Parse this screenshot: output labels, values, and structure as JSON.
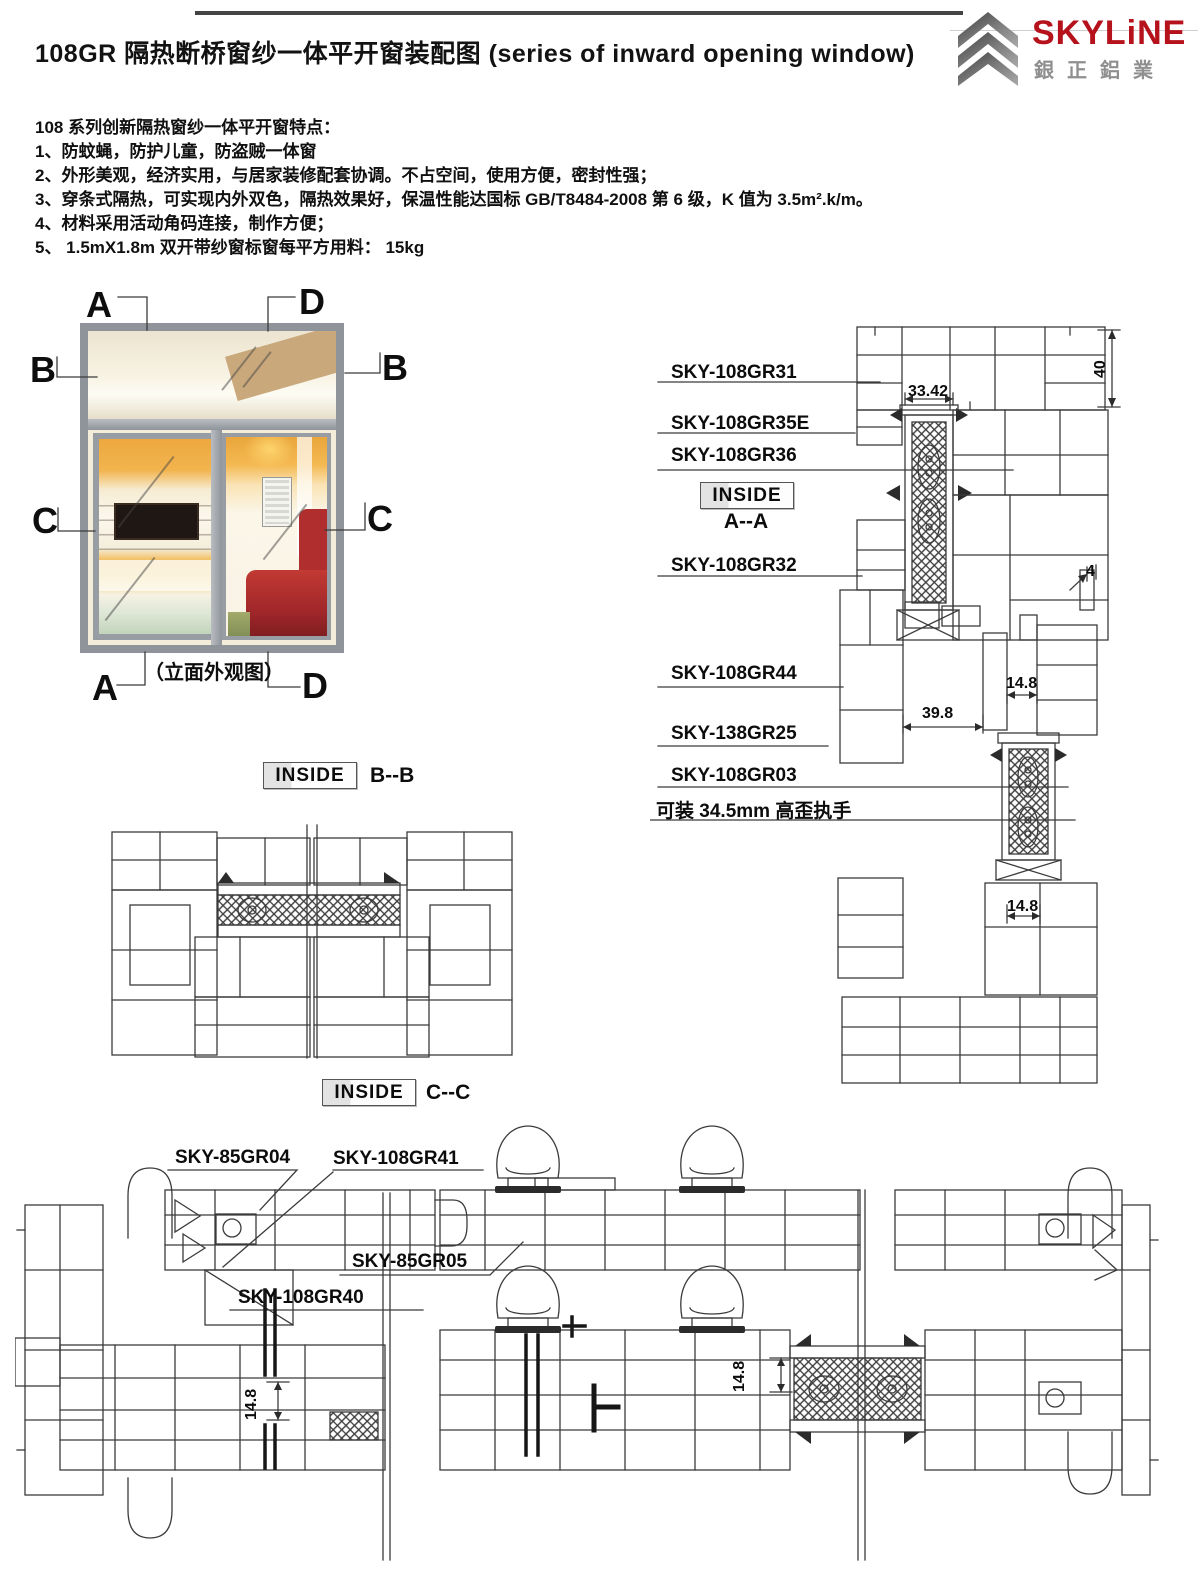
{
  "header": {
    "title_zh": "108GR 隔热断桥窗纱一体平开窗装配图",
    "title_en": "(series of inward opening window)",
    "logo": {
      "brand": "SKYLiNE",
      "sub": "銀正鋁業",
      "brand_color": "#b5121b"
    }
  },
  "features": {
    "heading": "108 系列创新隔热窗纱一体平开窗特点：",
    "items": [
      "1、防蚊蝇，防护儿童，防盗贼一体窗",
      "2、外形美观，经济实用，与居家装修配套协调。不占空间，使用方便，密封性强；",
      "3、穿条式隔热，可实现内外双色，隔热效果好，保温性能达国标 GB/T8484-2008 第 6 级，K 值为 3.5m².k/m。",
      "4、材料采用活动角码连接，制作方便；",
      "5、 1.5mX1.8m 双开带纱窗标窗每平方用料： 15kg"
    ]
  },
  "elevation": {
    "caption": "（立面外观图）",
    "marker_a": "A",
    "marker_b": "B",
    "marker_c": "C",
    "marker_d": "D"
  },
  "sections": {
    "aa": {
      "box": "INSIDE",
      "name": "A--A"
    },
    "bb": {
      "box": "INSIDE",
      "name": "B--B"
    },
    "cc": {
      "box": "INSIDE",
      "name": "C--C"
    }
  },
  "aa_drawing": {
    "part1": "SKY-108GR31",
    "part2": "SKY-108GR35E",
    "part3": "SKY-108GR36",
    "part4": "SKY-108GR32",
    "part5": "SKY-108GR44",
    "part6": "SKY-138GR25",
    "part7": "SKY-108GR03",
    "note": "可装 34.5mm 高歪执手",
    "dims": {
      "top_width": "33.42",
      "frame_height": "40",
      "bead": "4",
      "gap_top": "14.8",
      "overlap": "39.8",
      "gap_bottom": "14.8"
    }
  },
  "cc_drawing": {
    "part1": "SKY-85GR04",
    "part2": "SKY-108GR41",
    "part3": "SKY-85GR05",
    "part4": "SKY-108GR40",
    "dims": {
      "left": "14.8",
      "right": "14.8"
    }
  }
}
